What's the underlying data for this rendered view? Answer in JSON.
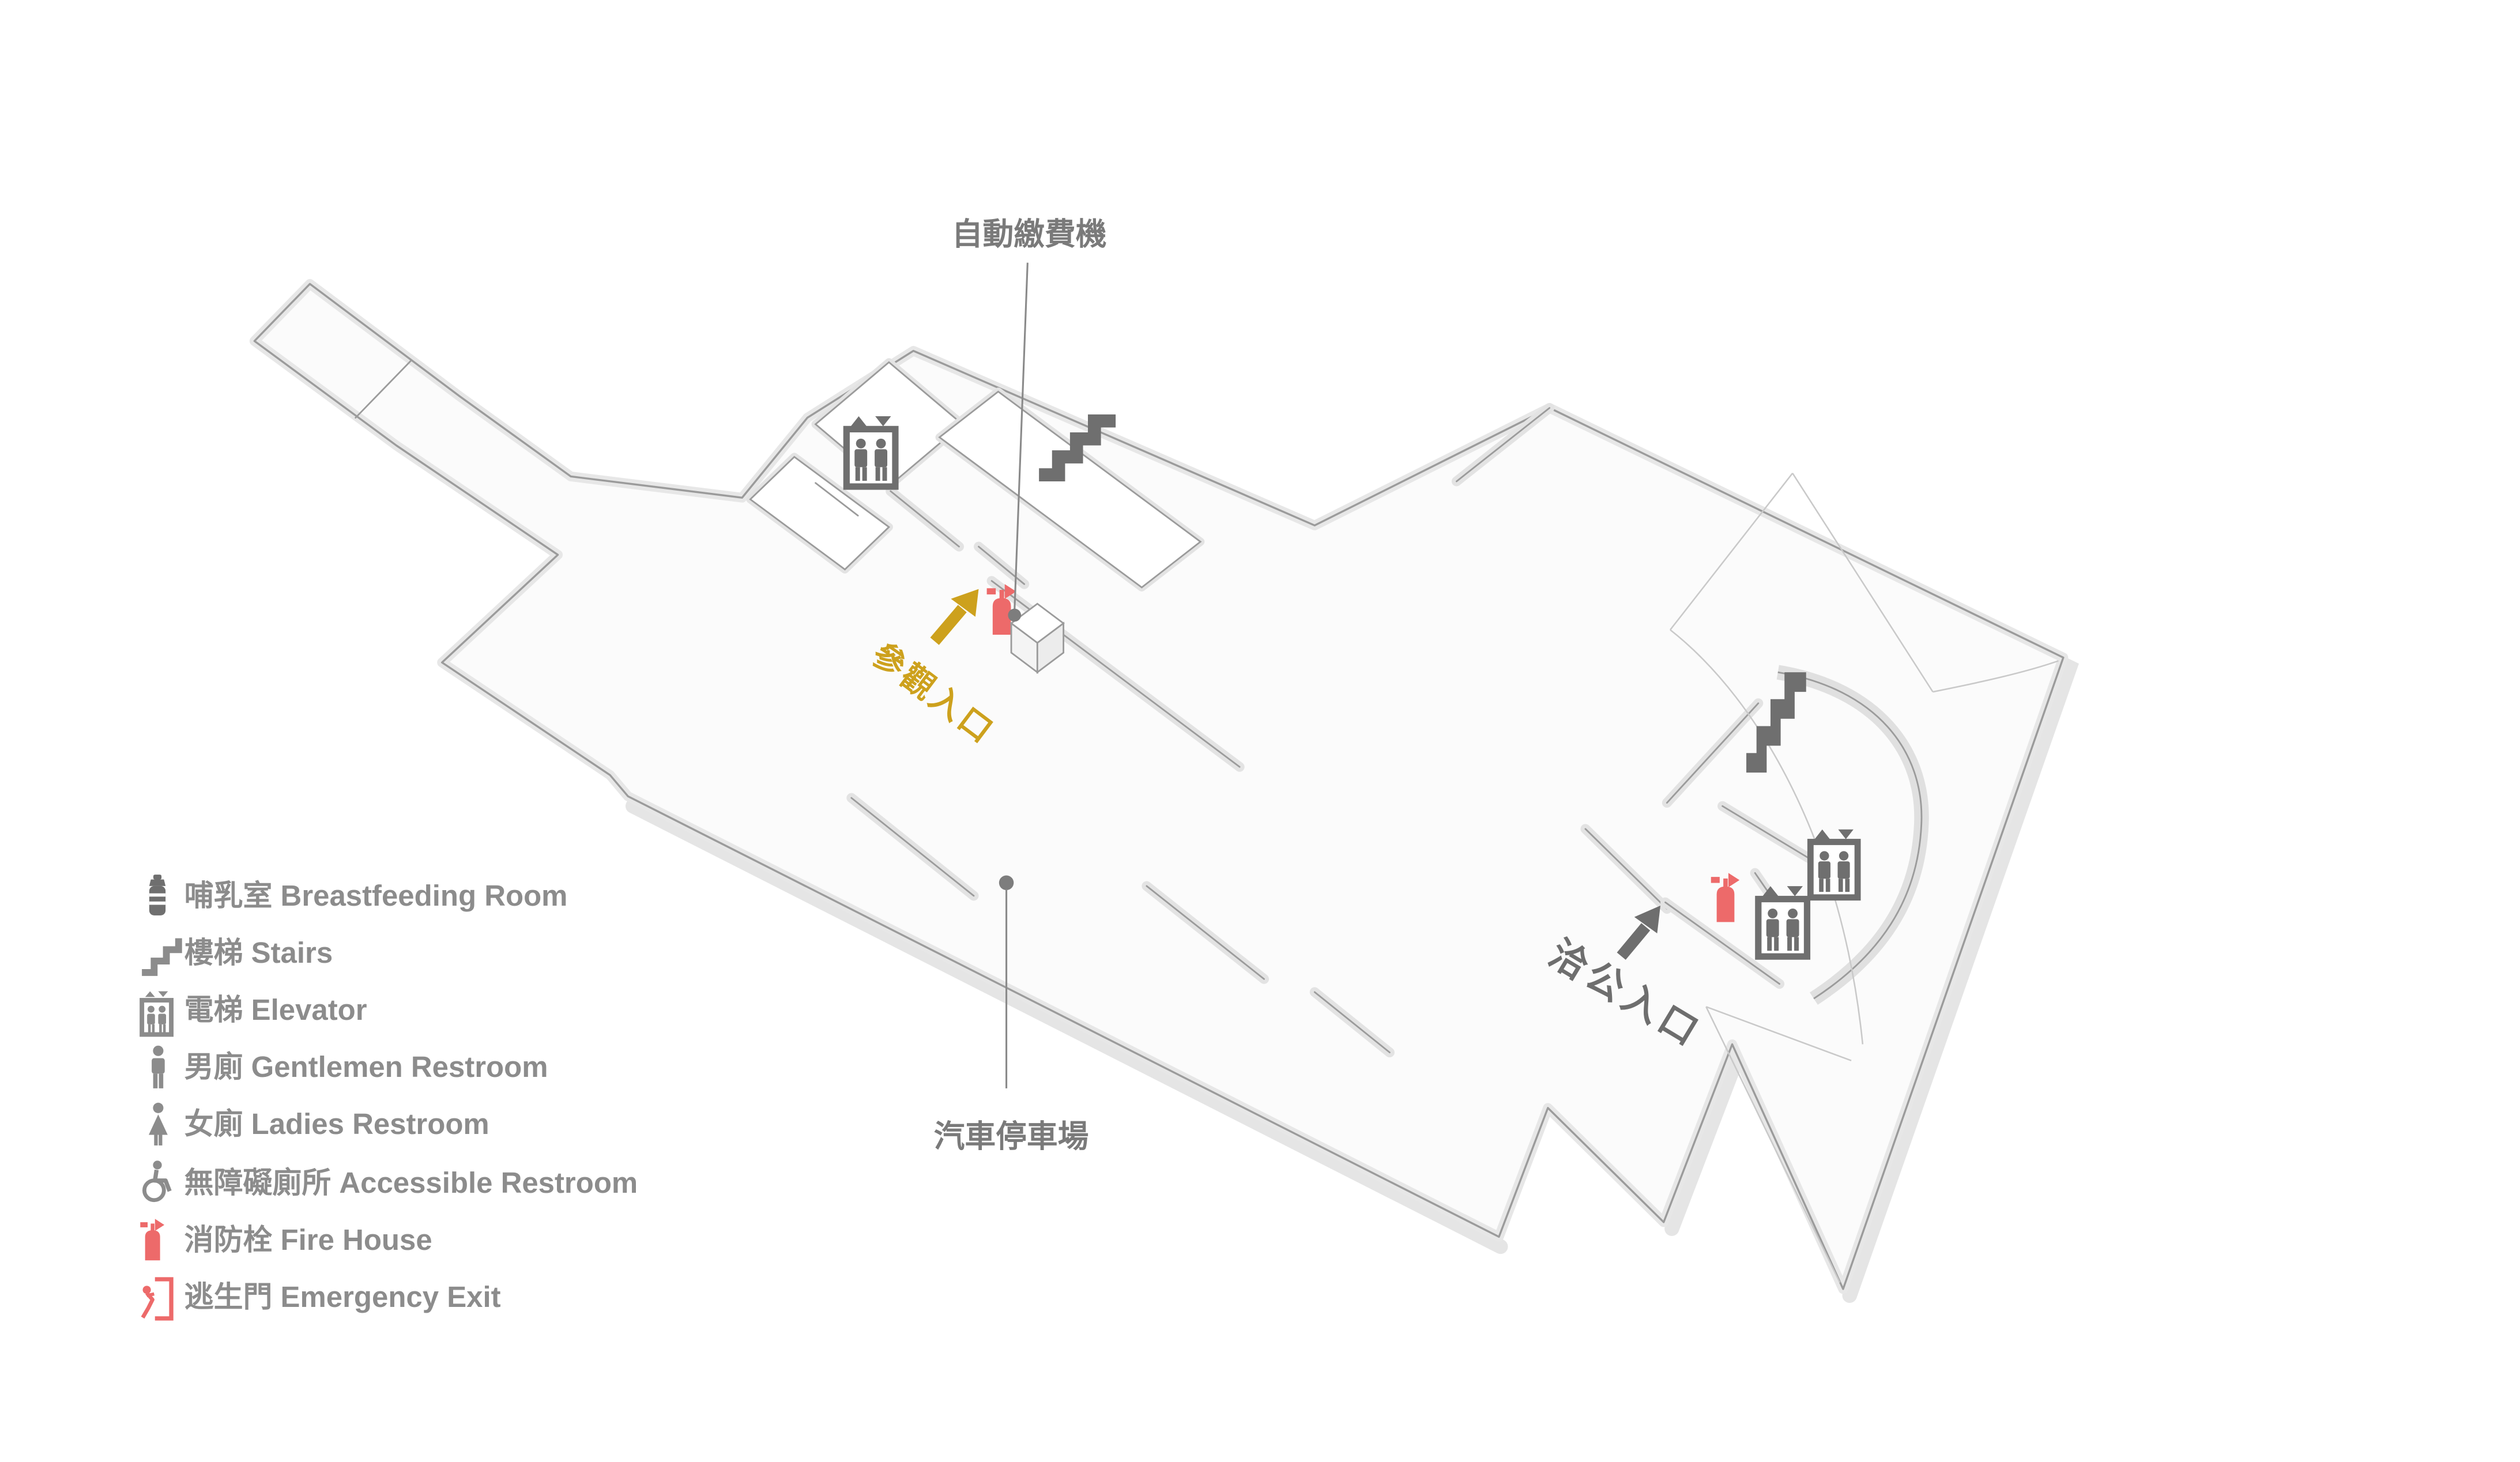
{
  "page": {
    "background": "#ffffff",
    "type": "parking-floor-plan"
  },
  "colors": {
    "accent_gold": "#CDA11D",
    "alert_red": "#ED6A6A",
    "icon_gray": "#6F6F6F",
    "label_gray": "#7A7A7A",
    "legend_text_gray": "#8C8C8C",
    "wall_stroke": "#9B9B9B",
    "wall_fill": "#E6E6E6",
    "floor_fill": "#FBFBFB"
  },
  "map": {
    "labels": {
      "payment_machine": "自動繳費機",
      "visitor_entrance": "參觀入口",
      "business_entrance": "洽公入口",
      "parking_lot": "汽車停車場"
    },
    "icons": {
      "elevator": "elevator-icon",
      "stairs": "stairs-icon",
      "fire_extinguisher": "fire-extinguisher-icon",
      "payment_machine_box": "payment-machine-box",
      "visitor_arrow": "visitor-entrance-arrow",
      "business_arrow": "business-entrance-arrow"
    }
  },
  "legend": {
    "items": [
      {
        "id": "breastfeeding",
        "icon": "breastfeeding-room-icon",
        "label": "哺乳室 Breastfeeding Room",
        "color": "#8C8C8C"
      },
      {
        "id": "stairs",
        "icon": "stairs-icon",
        "label": "樓梯 Stairs",
        "color": "#8C8C8C"
      },
      {
        "id": "elevator",
        "icon": "elevator-icon",
        "label": "電梯 Elevator",
        "color": "#8C8C8C"
      },
      {
        "id": "gentlemen",
        "icon": "gentlemen-restroom-icon",
        "label": "男廁 Gentlemen Restroom",
        "color": "#8C8C8C"
      },
      {
        "id": "ladies",
        "icon": "ladies-restroom-icon",
        "label": "女廁 Ladies Restroom",
        "color": "#8C8C8C"
      },
      {
        "id": "accessible",
        "icon": "accessible-restroom-icon",
        "label": "無障礙廁所  Accessible Restroom",
        "color": "#8C8C8C"
      },
      {
        "id": "fire",
        "icon": "fire-extinguisher-icon",
        "label": "消防栓 Fire House",
        "color": "#ED6A6A"
      },
      {
        "id": "exit",
        "icon": "emergency-exit-icon",
        "label": "逃生門 Emergency Exit",
        "color": "#ED6A6A"
      }
    ]
  }
}
